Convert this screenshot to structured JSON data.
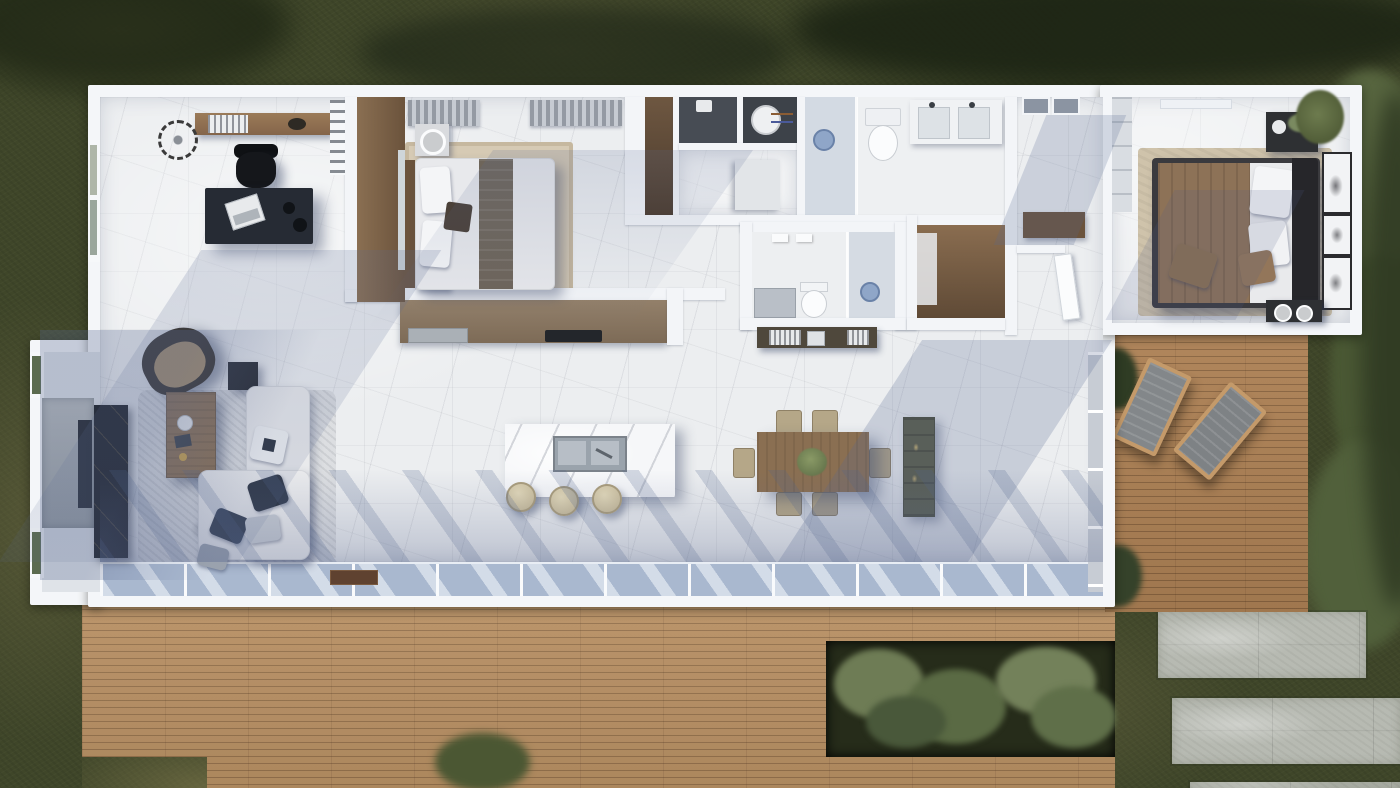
{
  "scene": {
    "title": "Top-down 3D rendered floor plan of a single-storey house",
    "view": "top-down architectural render",
    "rooms": [
      {
        "name": "Home Office",
        "furniture": [
          "wall shelf with books",
          "dark desk",
          "laptop",
          "office chair",
          "round wall ornament",
          "west window",
          "book niche"
        ]
      },
      {
        "name": "Guest Bedroom",
        "furniture": [
          "double bed with dark runner",
          "white pillows",
          "two nightstands",
          "two round table lamps",
          "beige area rug",
          "wood wardrobe",
          "gray curtains",
          "serving tray"
        ]
      },
      {
        "name": "Utility / Laundry",
        "furniture": [
          "washing machine",
          "linen closet",
          "white appliance",
          "powder room counter"
        ]
      },
      {
        "name": "Main Bathroom",
        "furniture": [
          "walk-in shower",
          "toilet",
          "double vanity with two sinks",
          "two skylights"
        ]
      },
      {
        "name": "Second Bathroom",
        "furniture": [
          "walk-in shower",
          "toilet",
          "gray vanity",
          "mirror lights"
        ]
      },
      {
        "name": "Walk-in Closet",
        "furniture": [
          "wood shelving"
        ]
      },
      {
        "name": "Hallway",
        "furniture": [
          "console sideboard with books",
          "interior door"
        ]
      },
      {
        "name": "Master Bedroom",
        "furniture": [
          "double bed",
          "brown throw blanket",
          "white pillows",
          "brown accent pillows",
          "dark headboard",
          "two dark nightstands",
          "flower vase",
          "three framed artworks",
          "beige area rug",
          "gray wardrobe",
          "corner plant"
        ]
      },
      {
        "name": "Kitchen",
        "furniture": [
          "wood counter with dark cooktop",
          "marble island",
          "double stainless sink",
          "three beige bar stools"
        ]
      },
      {
        "name": "Dining Area",
        "furniture": [
          "rectangular wood table",
          "six upholstered chairs",
          "green centerpiece",
          "tall olive cabinet"
        ]
      },
      {
        "name": "Living Room",
        "furniture": [
          "L-shaped white sofa",
          "navy and gray throw pillows",
          "wood coffee table",
          "tan armchair",
          "black side table",
          "black marble media cabinet",
          "stone TV wall with TV",
          "mottled gray rug",
          "west windows",
          "doormat"
        ]
      }
    ],
    "outdoor": {
      "lawn": "olive-green grass with tree canopies and shrubs",
      "main_deck": "wide wood plank deck along the south facade",
      "side_deck": {
        "description": "east wood deck",
        "lounge_chairs": 2
      },
      "planter": "ornamental grass bed cut into the south deck",
      "concrete_pavers": 3,
      "potted_plants": 2
    },
    "counts": {
      "bedrooms": 2,
      "bathrooms": 2,
      "dining_chairs": 6,
      "bar_stools": 3,
      "lounge_chairs": 2,
      "vanity_sinks": 2,
      "skylights": 2,
      "art_frames": 3
    },
    "palette": {
      "grass": "#3f4629",
      "grass_light": "#6c6845",
      "foliage_dark": "#202816",
      "shrub": "#57653f",
      "deck": "#b78f63",
      "deck_side": "#ad8155",
      "house_wall": "#f4f6f9",
      "marble": "#eceef0",
      "shadow_blue": "#5a6a92",
      "glass": "#a9b8cf",
      "wood_furniture": "#8a6f52",
      "desk_navy": "#262b34",
      "black_marble": "#141619",
      "sofa_white": "#e9eaec",
      "rug_living": "#dcdee1",
      "rug_beige": "#cfc3ab",
      "blanket_brown": "#8d7257",
      "olive_cabinet": "#5a5c48",
      "concrete": "#b7bab2",
      "lounge_canvas": "#83878a",
      "stool_beige": "#d6cbaa",
      "runner_gray": "#6e655a"
    }
  }
}
